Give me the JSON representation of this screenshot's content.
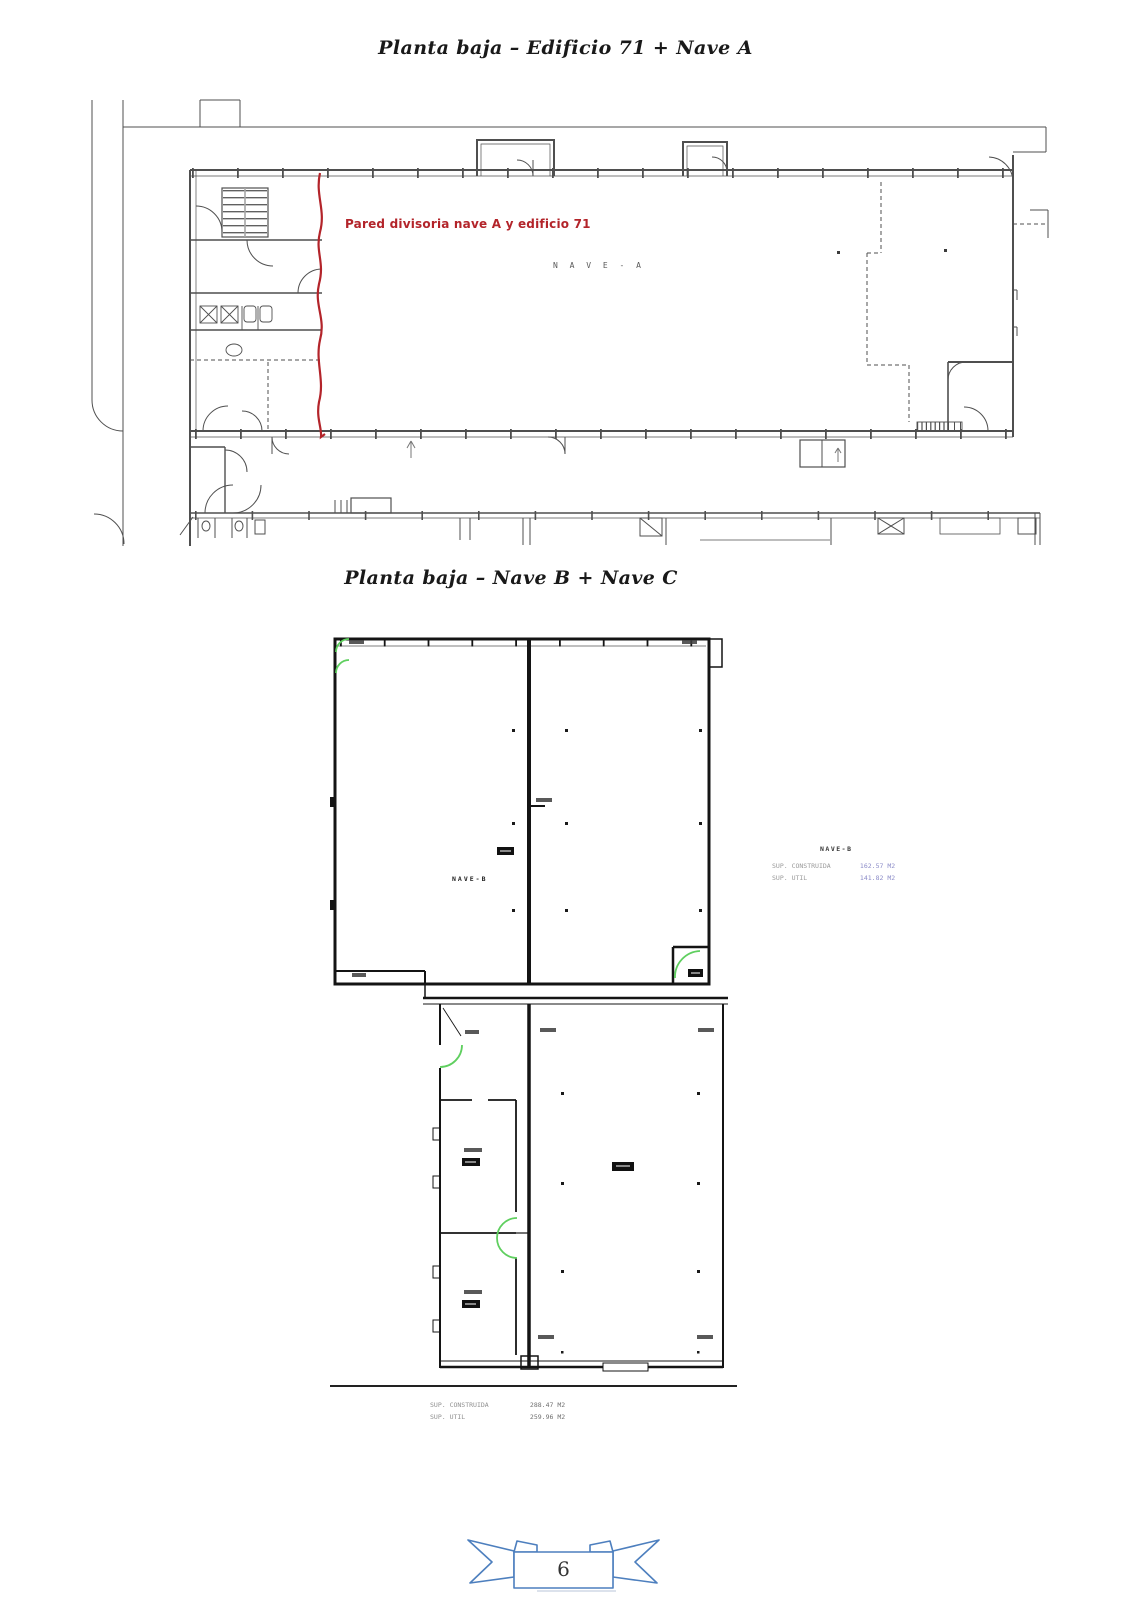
{
  "document": {
    "section1_title": "Planta baja – Edificio 71 + Nave A",
    "section2_title": "Planta baja – Nave B + Nave C",
    "page_number": "6"
  },
  "plan1": {
    "hall_label": "N A V E - A",
    "annotation": "Pared divisoria nave A y edificio 71"
  },
  "plan2": {
    "hall_label": "NAVE-B",
    "right_info": {
      "title": "NAVE-B",
      "rows": [
        {
          "label": "SUP. CONSTRUIDA",
          "value": "162.57 M2"
        },
        {
          "label": "SUP. UTIL",
          "value": "141.82 M2"
        }
      ]
    },
    "bottom_info": {
      "rows": [
        {
          "label": "SUP. CONSTRUIDA",
          "value": "288.47 M2"
        },
        {
          "label": "SUP. UTIL",
          "value": "259.96 M2"
        }
      ]
    }
  },
  "colors": {
    "annotation_red": "#b3242a",
    "door_green": "#5fcf5f",
    "value_blue": "#8c8cc8",
    "ribbon_blue": "#4d7fbe",
    "plan1_line": "#4f4f4f",
    "plan2_wall": "#141414"
  }
}
